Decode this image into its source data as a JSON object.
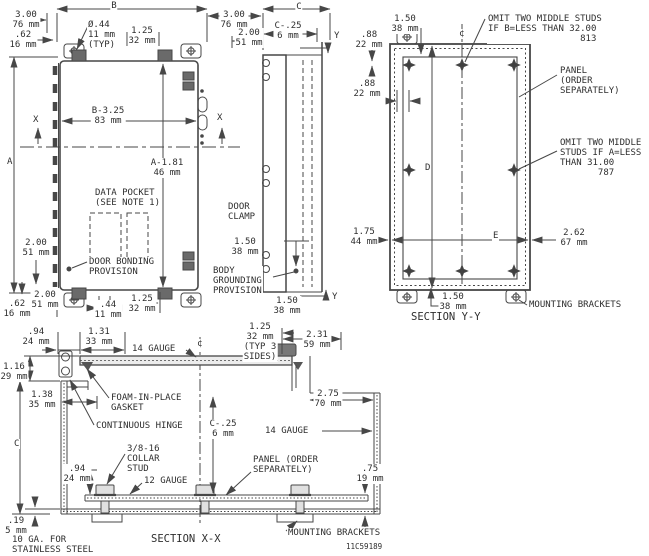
{
  "colors": {
    "line": "#474747",
    "text": "#2e2e2e",
    "background": "#ffffff",
    "hardware_fill": "#6a6a6a"
  },
  "labels": [
    {
      "name": "dim-b",
      "text": "B"
    },
    {
      "name": "dim-300-top-left",
      "text": "3.00\n76 mm"
    },
    {
      "name": "dim-62-top-left",
      "text": ".62\n16 mm"
    },
    {
      "name": "note-hole-dia",
      "text": "Ø.44\n11 mm\n(TYP)"
    },
    {
      "name": "dim-125-top",
      "text": "1.25\n32 mm"
    },
    {
      "name": "dim-300-mid",
      "text": "3.00\n76 mm"
    },
    {
      "name": "dim-200-mid",
      "text": "2.00\n51 mm"
    },
    {
      "name": "dim-c-top",
      "text": "C"
    },
    {
      "name": "dim-c25-side",
      "text": "C-.25\n6 mm"
    },
    {
      "name": "cutline-y-top",
      "text": "Y"
    },
    {
      "name": "dim-a",
      "text": "A"
    },
    {
      "name": "cutline-x-left",
      "text": "X"
    },
    {
      "name": "cutline-x-right",
      "text": "X"
    },
    {
      "name": "dim-b325",
      "text": "B-3.25\n83 mm"
    },
    {
      "name": "dim-a181",
      "text": "A-1.81\n46 mm"
    },
    {
      "name": "note-data-pocket",
      "text": "DATA POCKET\n(SEE NOTE 1)"
    },
    {
      "name": "dim-200-left",
      "text": "2.00\n51 mm"
    },
    {
      "name": "note-door-bonding",
      "text": "DOOR BONDING\nPROVISION"
    },
    {
      "name": "note-door-clamp",
      "text": "DOOR\nCLAMP"
    },
    {
      "name": "dim-62-bottom",
      "text": ".62\n16 mm"
    },
    {
      "name": "dim-200-bottom",
      "text": "2.00\n51 mm"
    },
    {
      "name": "dim-44-bottom",
      "text": ".44\n11 mm"
    },
    {
      "name": "dim-125-bottom",
      "text": "1.25\n32 mm"
    },
    {
      "name": "dim-150-grounding",
      "text": "1.50\n38 mm"
    },
    {
      "name": "note-body-grounding",
      "text": "BODY\nGROUNDING\nPROVISION"
    },
    {
      "name": "dim-150-side-bottom",
      "text": "1.50\n38 mm"
    },
    {
      "name": "cutline-y-bottom",
      "text": "Y"
    },
    {
      "name": "dim-150-yy-top",
      "text": "1.50\n38 mm"
    },
    {
      "name": "dim-88-yy-1",
      "text": ".88\n22 mm"
    },
    {
      "name": "dim-88-yy-2",
      "text": ".88\n22 mm"
    },
    {
      "name": "note-omit-studs-b",
      "text": "OMIT TWO MIDDLE STUDS\nIF B=LESS THAN 32.00\n                 813"
    },
    {
      "name": "note-panel-yy",
      "text": "PANEL\n(ORDER\nSEPARATELY)"
    },
    {
      "name": "dim-d",
      "text": "D"
    },
    {
      "name": "note-omit-studs-a",
      "text": "OMIT TWO MIDDLE\nSTUDS IF A=LESS\nTHAN 31.00\n       787"
    },
    {
      "name": "dim-175-yy",
      "text": "1.75\n44 mm"
    },
    {
      "name": "dim-e",
      "text": "E"
    },
    {
      "name": "dim-262-yy",
      "text": "2.62\n67 mm"
    },
    {
      "name": "dim-150-yy-bottom",
      "text": "1.50\n38 mm"
    },
    {
      "name": "note-mounting-brackets-yy",
      "text": "MOUNTING BRACKETS"
    },
    {
      "name": "title-section-yy",
      "text": "SECTION Y-Y"
    },
    {
      "name": "dim-94-xx-top",
      "text": ".94\n24 mm"
    },
    {
      "name": "dim-131-xx",
      "text": "1.31\n33 mm"
    },
    {
      "name": "note-14-gauge-top",
      "text": "14 GAUGE"
    },
    {
      "name": "centerline-symbol-xx",
      "text": "¢"
    },
    {
      "name": "dim-125-typ3",
      "text": "1.25\n32 mm\n(TYP 3\nSIDES)"
    },
    {
      "name": "dim-231-xx",
      "text": "2.31\n59 mm"
    },
    {
      "name": "dim-116-xx",
      "text": "1.16\n29 mm"
    },
    {
      "name": "dim-138-xx",
      "text": "1.38\n35 mm"
    },
    {
      "name": "note-foam-gasket",
      "text": "FOAM-IN-PLACE\nGASKET"
    },
    {
      "name": "dim-275-xx",
      "text": "2.75\n70 mm"
    },
    {
      "name": "note-continuous-hinge",
      "text": "CONTINUOUS HINGE"
    },
    {
      "name": "dim-c25-xx",
      "text": "C-.25\n6 mm"
    },
    {
      "name": "note-14-gauge-right",
      "text": "14 GAUGE"
    },
    {
      "name": "dim-c-left",
      "text": "C"
    },
    {
      "name": "note-collar-stud",
      "text": "3/8-16\nCOLLAR\nSTUD"
    },
    {
      "name": "dim-94-xx-bottom",
      "text": ".94\n24 mm"
    },
    {
      "name": "note-12-gauge",
      "text": "12 GAUGE"
    },
    {
      "name": "note-panel-xx",
      "text": "PANEL (ORDER\nSEPARATELY)"
    },
    {
      "name": "dim-75-xx",
      "text": ".75\n19 mm"
    },
    {
      "name": "dim-19-xx",
      "text": ".19\n5 mm"
    },
    {
      "name": "note-10-gauge-stainless",
      "text": "10 GA. FOR\nSTAINLESS STEEL"
    },
    {
      "name": "note-mounting-brackets-xx",
      "text": "MOUNTING BRACKETS"
    },
    {
      "name": "title-section-xx",
      "text": "SECTION X-X"
    },
    {
      "name": "drawing-number",
      "text": "11C59189"
    },
    {
      "name": "centerline-symbol-yy",
      "text": "¢"
    }
  ]
}
